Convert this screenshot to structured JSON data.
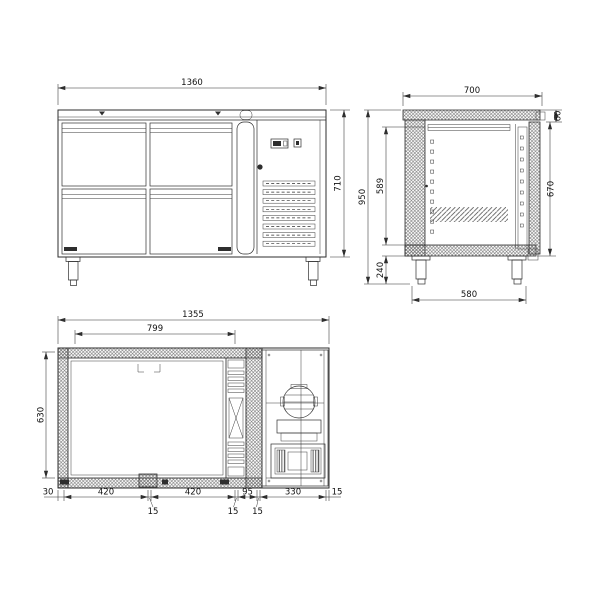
{
  "drawing": {
    "front": {
      "width": "1360",
      "height": "710"
    },
    "side": {
      "depth": "700",
      "worktop_thickness": "60",
      "door_height": "670",
      "overall_height": "950",
      "interior_height": "589",
      "leg_height": "240",
      "leg_span": "580"
    },
    "plan": {
      "width": "1355",
      "door_span": "799",
      "depth": "630",
      "chain": [
        "30",
        "420",
        "15",
        "420",
        "15",
        "95",
        "15",
        "330",
        "15"
      ]
    }
  }
}
